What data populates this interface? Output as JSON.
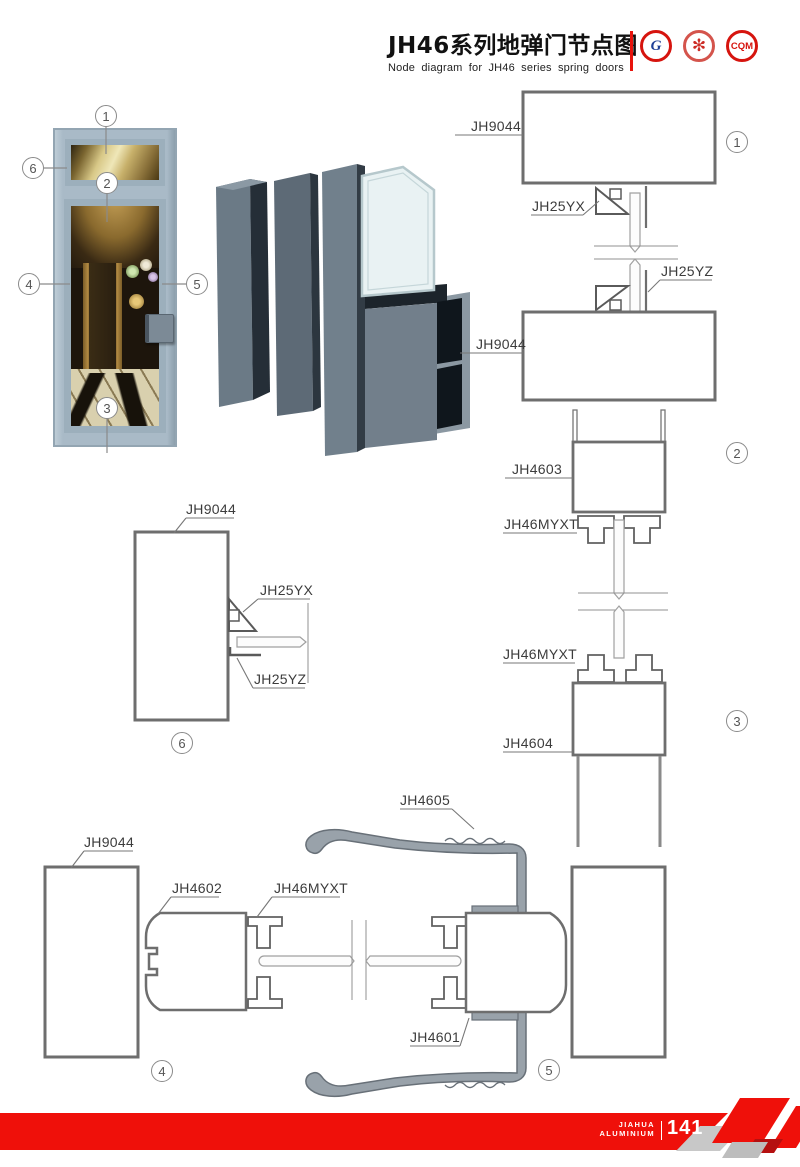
{
  "header": {
    "title_cn": "JH46系列地弹门节点图",
    "title_en": "Node diagram for JH46 series spring doors",
    "logos": {
      "logo1": "G",
      "logo2": "✻",
      "logo3": "CQM"
    },
    "accent_red": "#e8130c"
  },
  "photo_callouts": {
    "c1": "1",
    "c2": "2",
    "c3": "3",
    "c4": "4",
    "c5": "5",
    "c6": "6"
  },
  "detail_numbers": {
    "n1": "1",
    "n2": "2",
    "n3": "3",
    "n4": "4",
    "n5": "5",
    "n6": "6"
  },
  "labels": {
    "d1_frame_top": "JH9044",
    "d1_bead_top": "JH25YX",
    "d1_bead_bottom": "JH25YZ",
    "d2_frame": "JH9044",
    "d2_profile": "JH4603",
    "d2_strip": "JH46MYXT",
    "d3_strip": "JH46MYXT",
    "d3_profile": "JH4604",
    "d6_frame": "JH9044",
    "d6_bead_top": "JH25YX",
    "d6_bead_bottom": "JH25YZ",
    "d4_frame": "JH9044",
    "d4_stile": "JH4602",
    "d4_strip": "JH46MYXT",
    "d5_cover": "JH4605",
    "d5_stile": "JH4601"
  },
  "footer": {
    "brand_top": "JIAHUA",
    "brand_bottom": "ALUMINIUM",
    "page": "141"
  },
  "colors": {
    "line_gray": "#6e6e6e",
    "thin_gray": "#909090",
    "cover_gray": "#99a2aa",
    "band_red": "#ef100a"
  }
}
